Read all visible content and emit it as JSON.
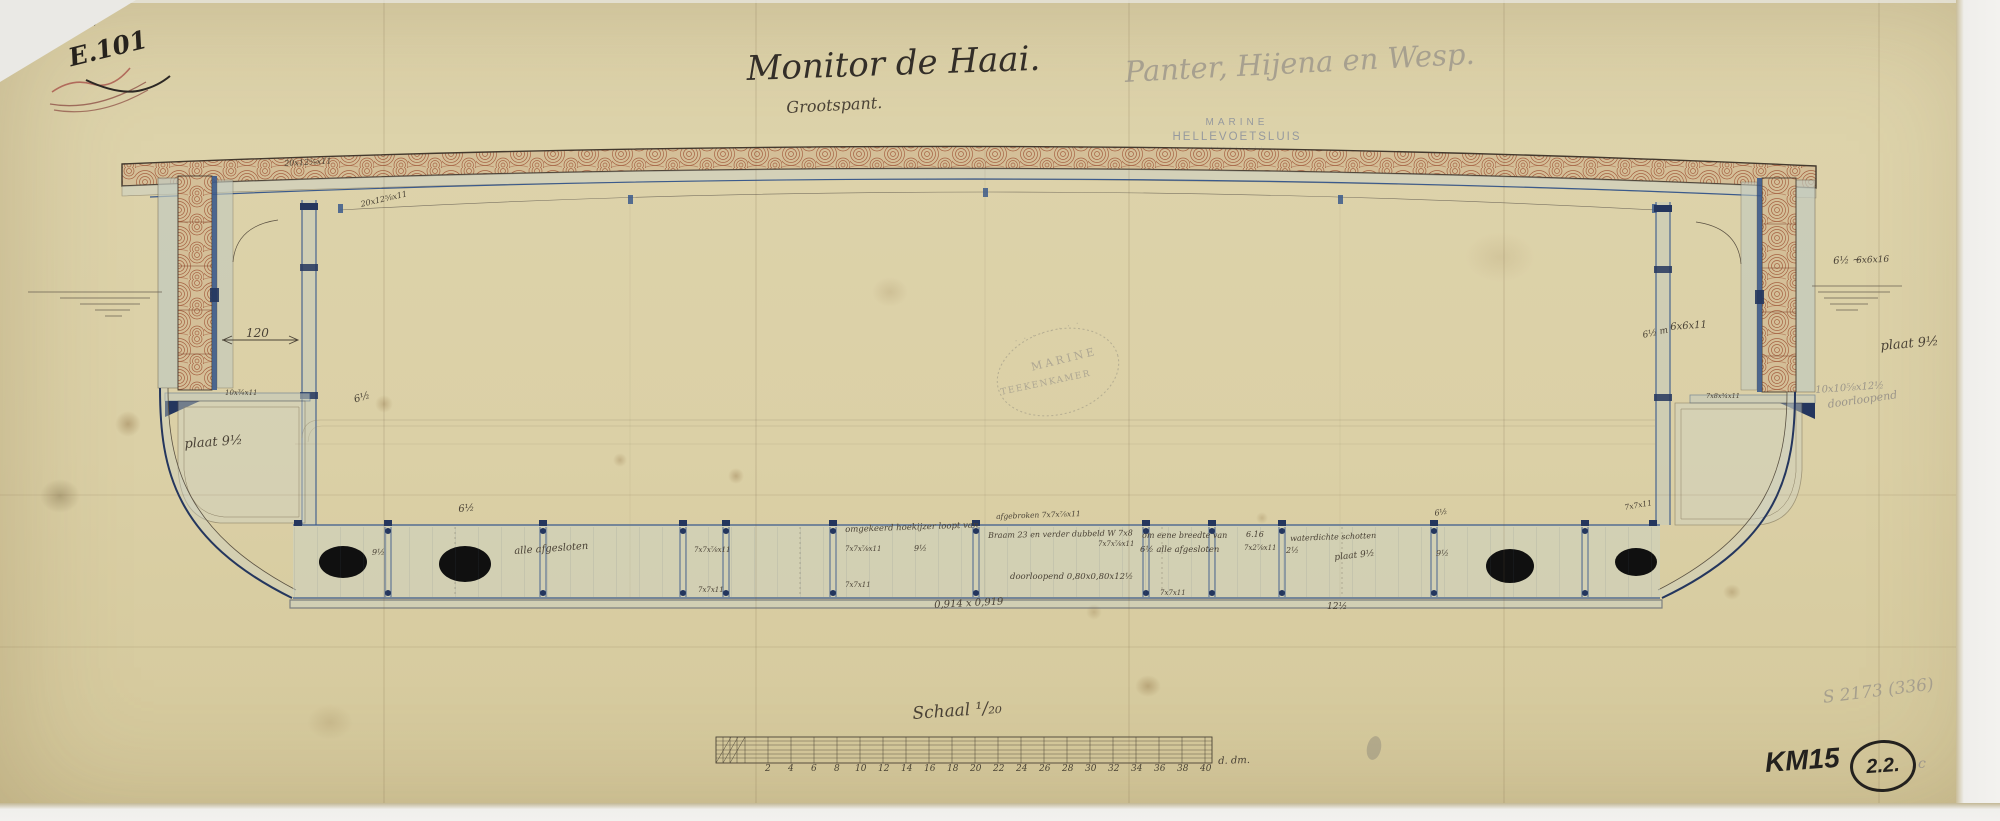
{
  "document": {
    "archive_number": "N° 387",
    "shelf_mark": "E.101",
    "title": "Monitor de Haai.",
    "subtitle": "Grootspant.",
    "pencil_note": "Panter, Hijena en Wesp.",
    "catalog_pencil": "S 2173 (336)",
    "collection_mark": "KM15",
    "circle_mark": "2.2.",
    "circle_suffix": "c"
  },
  "stamps": {
    "marine_line1": "MARINE",
    "marine_line2": "HELLEVOETSLUIS",
    "marine_line3": "· · · · · · · · ·",
    "oval_top": "· · · · · · · ·",
    "oval_center": "MARINE",
    "oval_bottom": "TEEKENKAMER"
  },
  "scalebar": {
    "title": "Schaal ¹/₂₀",
    "suffix": "d. dm.",
    "numbers": [
      "2",
      "4",
      "6",
      "8",
      "10",
      "12",
      "14",
      "16",
      "18",
      "20",
      "22",
      "24",
      "26",
      "28",
      "30",
      "32",
      "34",
      "36",
      "38",
      "40"
    ]
  },
  "annotations": {
    "deck_dim_a": "20x12⅝x11",
    "deck_dim_b": "20x12⅝x11",
    "dim_120": "120",
    "shelf_left": "10x¾x11",
    "plaat_left": "plaat 9½",
    "mark_6half_left": "6½",
    "band_6half": "6½",
    "band_9half_a": "9½",
    "alle_afgesloten_a": "alle afgesloten",
    "dim_7x7x78x11_a": "7x7x⅞x11",
    "dim_7x7x11_a": "7x7x11",
    "omgekeerd": "omgekeerd hoekijzer loopt van",
    "dim_7x7x78x11_b": "7x7x⅞x11",
    "dim_7x7x11_b": "7x7x11",
    "band_9half_b": "9½",
    "afgebroken": "afgebroken 7x7x⅞x11",
    "braam": "Braam 23 en verder dubbeld W 7x8",
    "dim_7x7x78x11_c": "7x7x⅞x11",
    "doorloopend_mid": "doorloopend 0,80x0,80x12½",
    "breedte": "om eene breedte van",
    "alle_afgesloten_b": "6½ alle afgesloten",
    "dim_7x7x11_c": "7x7x11",
    "n616": "6.16",
    "dim_7x278x11": "7x2⅞x11",
    "waterdicht": "waterdichte schotten",
    "frac_2half": "2½",
    "plaat_mid": "plaat 9½",
    "mark_6half_r": "6½",
    "band_9half_c": "9½",
    "dim_7x7x11_d": "7x7x11",
    "meas_0914": "0,914 x 0,919",
    "meas_12half": "12½",
    "r_6x6x11": "6x6x11",
    "r_6half_m": "6½ m",
    "r_6half": "6½ ~",
    "r_6x6x16": "6x6x16",
    "plaat_right": "plaat 9½",
    "r_dim_pencil": "10x10⅝x12½",
    "r_doorloopend": "doorloopend",
    "shelf_right": "7x8x¾x11"
  },
  "colors": {
    "paper": "#dbd0a6",
    "iron_blue": "#3b5a8c",
    "iron_dark": "#24365e",
    "wood_red": "#9a4a2c",
    "wash_gray": "#c6ccbf",
    "ink": "#433a2e",
    "graphite": "#9b958a"
  }
}
